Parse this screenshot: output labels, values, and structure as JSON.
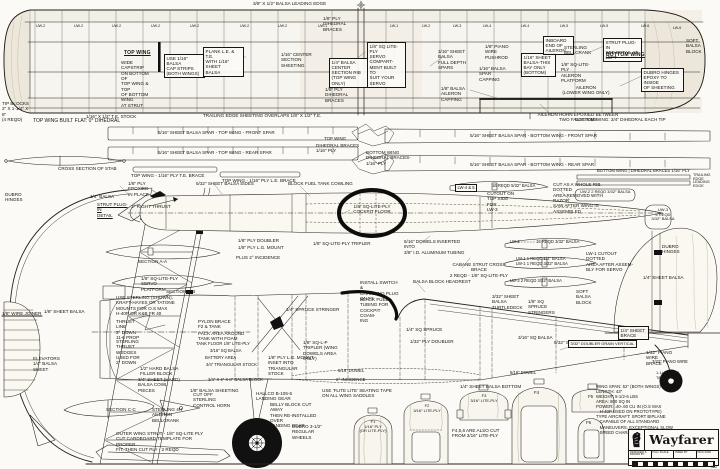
{
  "sheet": {
    "width": 720,
    "height": 469
  },
  "colors": {
    "paper": "#fbfaf6",
    "ink": "#18160f"
  },
  "title_block": {
    "title": "Wayfarer",
    "logo": "lion-crest-logo",
    "cells": [
      "DESIGNED &\nDRAWN BY",
      "FULL SCALE",
      "INKED BY",
      "DICK KIDD"
    ],
    "plan_number": "462"
  },
  "specs": {
    "lines": [
      "WING SPAN: 52″ (BOTH WINGS)",
      "LENGTH: 43″",
      "WEIGHT: 5-1/2-6 LBS",
      "AREA: 800 SQ IN",
      "POWER: .40-.60 CU IN (O.S MAX",
      "   H-40P USED ON PROTOTYPE)",
      "TYPE AIRCRAFT: SPORT BIPLANE",
      "   CAPABLE OF ALL STANDARD",
      "   MANEUVERS, EXCEPTIONAL SLOW",
      "   SPEED CHARACTERISTICS"
    ]
  },
  "annotations": [
    {
      "x": 2,
      "y": 101,
      "t": "TIP BLOCKS\n2″ X 1-1/4″ X 8″\n(4 REQD)",
      "w": 30
    },
    {
      "x": 124,
      "y": 51,
      "t": "TOP WING",
      "u": 1,
      "f": 1,
      "s": 5
    },
    {
      "x": 121,
      "y": 60,
      "t": "WIDE CAPSTRIP\nON BOTTOM OF\nTOP WING & TOP\nOF BOTTOM WING\nAT STRUT",
      "w": 34
    },
    {
      "x": 164,
      "y": 54,
      "t": "USE 1/16″ BALSA\nCAP STRIPS\n(BOTH WINGS)",
      "w": 36,
      "b": 1
    },
    {
      "x": 203,
      "y": 47,
      "t": "PLANK L.E. & T.E.\nWITH 1/16″ SHEET\nBALSA",
      "w": 36,
      "b": 1
    },
    {
      "x": 86,
      "y": 114,
      "t": "1/16″ X 1/2″ T.E. STOCK"
    },
    {
      "x": 253,
      "y": 1,
      "t": "3/8″ X 1/2″ BALSA LEADING EDGE"
    },
    {
      "x": 323,
      "y": 16,
      "t": "1/8″ PLY DIHEDRAL\nBRACES",
      "w": 38
    },
    {
      "x": 281,
      "y": 52,
      "t": "1/16″ CENTER\nSECTION SHEETING",
      "w": 36
    },
    {
      "x": 329,
      "y": 58,
      "t": "1/4″ BALSA CENTER\nSECTION RIB\n(TOP WING ONLY)",
      "w": 38,
      "b": 1
    },
    {
      "x": 367,
      "y": 42,
      "t": "1/8″ SQ LITE-PLY\nSERVO COMPART-\nMENT BUILT TO\nSUIT YOUR SERVO",
      "w": 34,
      "b": 1
    },
    {
      "x": 438,
      "y": 49,
      "t": "3/16″ SHEET BALSA\nFULL DEPTH\nSPARS",
      "w": 38
    },
    {
      "x": 325,
      "y": 87,
      "t": "1/8″ PLY DIHEDRAL\nBRACES",
      "w": 38
    },
    {
      "x": 441,
      "y": 86,
      "t": "1/8″ BALSA AILERON\nCAPPING",
      "w": 40
    },
    {
      "x": 203,
      "y": 113,
      "t": "TRAILING EDGE SHEETING OVERLAPS 1/8″ X 1/2″ T.E."
    },
    {
      "x": 485,
      "y": 44,
      "t": "1/8″ PIANO WIRE\nPUSHROD",
      "w": 32
    },
    {
      "x": 479,
      "y": 66,
      "t": "1/16″ BALSA SPAR\nCAPPING",
      "w": 32
    },
    {
      "x": 521,
      "y": 53,
      "t": "1/16″ SHEET\nBALSA-THIS\nBAY ONLY\n(BOTTOM)",
      "w": 30,
      "b": 1
    },
    {
      "x": 543,
      "y": 36,
      "t": "INBOARD\nEND OF\nAILERON",
      "w": 26,
      "b": 1
    },
    {
      "x": 564,
      "y": 45,
      "t": "STERLING\nBELLCRANK",
      "w": 28
    },
    {
      "x": 561,
      "y": 62,
      "t": "1/8″ SQ-LITE-PLY\nAILERON\nPLATFORM",
      "w": 36
    },
    {
      "x": 603,
      "y": 38,
      "t": "STRUT PLUG-IN\nSEE DETAIL AT\nLEFT",
      "w": 34,
      "b": 1
    },
    {
      "x": 606,
      "y": 53,
      "t": "BOTTOM WING",
      "u": 1,
      "f": 1,
      "s": 5
    },
    {
      "x": 686,
      "y": 38,
      "t": "SOFT\nBALSA\nBLOCK",
      "w": 24
    },
    {
      "x": 641,
      "y": 68,
      "t": "DUBRO HINGES\nEPOXY TO INSIDE\nOF SHEETING",
      "w": 38,
      "b": 1
    },
    {
      "x": 556,
      "y": 85,
      "t": "AILERON\n(LOWER WING ONLY)",
      "w": 60,
      "c": 1
    },
    {
      "x": 535,
      "y": 112,
      "t": "AILERON HORN EPOXIED BETWEEN\nTWO FALSE RIBS",
      "w": 86,
      "c": 1
    },
    {
      "x": 36,
      "y": 24,
      "t": "UW-2",
      "s": 3.6
    },
    {
      "x": 74,
      "y": 24,
      "t": "UW-2",
      "s": 3.6
    },
    {
      "x": 112,
      "y": 24,
      "t": "UW-2",
      "s": 3.6
    },
    {
      "x": 151,
      "y": 24,
      "t": "UW-2",
      "s": 3.6
    },
    {
      "x": 190,
      "y": 24,
      "t": "UW-2",
      "s": 3.6
    },
    {
      "x": 240,
      "y": 24,
      "t": "UW-2",
      "s": 3.6
    },
    {
      "x": 278,
      "y": 24,
      "t": "UW-2",
      "s": 3.6
    },
    {
      "x": 318,
      "y": 24,
      "t": "UW-1",
      "s": 3.6
    },
    {
      "x": 390,
      "y": 24,
      "t": "LW-1",
      "s": 3.6
    },
    {
      "x": 422,
      "y": 24,
      "t": "LW-2",
      "s": 3.6
    },
    {
      "x": 453,
      "y": 24,
      "t": "LW-3",
      "s": 3.6
    },
    {
      "x": 483,
      "y": 24,
      "t": "LW-4",
      "s": 3.6
    },
    {
      "x": 521,
      "y": 24,
      "t": "LW-4",
      "s": 3.6
    },
    {
      "x": 560,
      "y": 24,
      "t": "LW-5",
      "s": 3.6
    },
    {
      "x": 600,
      "y": 24,
      "t": "LW-5",
      "s": 3.6
    },
    {
      "x": 641,
      "y": 24,
      "t": "LW-6",
      "s": 3.6
    },
    {
      "x": 673,
      "y": 26,
      "t": "LW-6",
      "s": 3.6
    },
    {
      "x": 33,
      "y": 119,
      "t": "TOP WING BUILT FLAT: 0° DIHEDRAL",
      "s": 5
    },
    {
      "x": 158,
      "y": 130,
      "t": "5/16″ SHEET BALSA SPAR - TOP WING - FRONT SPAR"
    },
    {
      "x": 158,
      "y": 150,
      "t": "5/16″ SHEET BALSA SPAR - TOP WING - REAR SPAR"
    },
    {
      "x": 324,
      "y": 136,
      "t": "TOP WING",
      "s": 4.4
    },
    {
      "x": 316,
      "y": 143,
      "t": "DIHEDRAL BRACES\n1/16″ PLY",
      "w": 44
    },
    {
      "x": 58,
      "y": 166,
      "t": "CROSS SECTION OF STAB"
    },
    {
      "x": 131,
      "y": 173,
      "t": "TOP WING - 1/16″ PLY T.E. BRACE"
    },
    {
      "x": 222,
      "y": 178,
      "t": "TOP WING - 1/16″ PLY L.E. BRACE"
    },
    {
      "x": 575,
      "y": 117,
      "t": "BOTTOM WING: 3/4″ DIHEDRAL EACH TIP",
      "s": 4.6
    },
    {
      "x": 470,
      "y": 133,
      "t": "5/16″ SHEET BALSA SPAR - BOTTOM WING - FRONT SPAR"
    },
    {
      "x": 470,
      "y": 162,
      "t": "5/16″ SHEET BALSA SPAR - BOTTOM WING - REAR SPAR"
    },
    {
      "x": 366,
      "y": 150,
      "t": "BOTTOM WING DIHEDRAL BRACES-\n1/16″ PLY",
      "w": 52
    },
    {
      "x": 597,
      "y": 169,
      "t": "BOTTOM WING | DIHEDRAL BRACES 1/16″ PLY",
      "s": 4.2
    },
    {
      "x": 693,
      "y": 173,
      "t": "TRAILING EDGE",
      "s": 3.8
    },
    {
      "x": 693,
      "y": 180,
      "t": "LEADING EDGE",
      "s": 3.8
    },
    {
      "x": 455,
      "y": 184,
      "t": "LW-4 & 5",
      "b": 1,
      "s": 4.2
    },
    {
      "x": 492,
      "y": 184,
      "t": "16 REQD 5/32″ BALSA",
      "s": 4.2
    },
    {
      "x": 553,
      "y": 182,
      "t": "CUT AS A WHOLE RIB. DOTTED\nAREA REMOVED WITH RAZOR\nSAW AFTER WING IS ASSEMBLED",
      "w": 66
    },
    {
      "x": 487,
      "y": 191,
      "t": "CUTOUT ON\nTOP SIDE FOR\nLW-3",
      "w": 28
    },
    {
      "x": 5,
      "y": 192,
      "t": "DUBRO\nHINGES",
      "w": 22
    },
    {
      "x": 90,
      "y": 194,
      "t": "1/4″ BALSA"
    },
    {
      "x": 97,
      "y": 202,
      "t": "STRUT PLUG-IN\nDETAIL",
      "w": 34,
      "u": 1
    },
    {
      "x": 128,
      "y": 181,
      "t": "1/8″ PLY EPOXIED\nIN PLACE",
      "w": 36
    },
    {
      "x": 131,
      "y": 204,
      "t": "3° RIGHT THRUST"
    },
    {
      "x": 196,
      "y": 181,
      "t": "5/32″ SHEET BALSA SIDES"
    },
    {
      "x": 288,
      "y": 181,
      "t": "BLOCK FUEL TANK COWLING"
    },
    {
      "x": 352,
      "y": 204,
      "t": "1/8″ SQ-LITE-PLY\nCOCKPIT FLOOR",
      "w": 40,
      "c": 1
    },
    {
      "x": 313,
      "y": 241,
      "t": "1/8″ SQ-LITE-PLY TRIPLER"
    },
    {
      "x": 404,
      "y": 239,
      "t": "5/16″ DOWELS INSERTED INTO\n3/8″ I.D. ALUMINUM TUBING",
      "w": 64
    },
    {
      "x": 238,
      "y": 238,
      "t": "1/8″ PLY DOUBLER"
    },
    {
      "x": 238,
      "y": 245,
      "t": "1/8″ PLY L.G. MOUNT"
    },
    {
      "x": 236,
      "y": 255,
      "t": "PLUS 2° INCIDENCE"
    },
    {
      "x": 446,
      "y": 262,
      "t": "CABANE STRUT CROSS BRACE\n2 REQD - 1/8″ SQ-LITE-PLY",
      "w": 66,
      "c": 1
    },
    {
      "x": 360,
      "y": 280,
      "t": "INSTALL SWITCH &\nCHARGING PLUG\nON F3",
      "w": 40
    },
    {
      "x": 413,
      "y": 279,
      "t": "BALSA BLOCK HEADREST"
    },
    {
      "x": 360,
      "y": 297,
      "t": "BLACK FUEL\nTUBING FOR\nCOCKPIT COAM-\nING",
      "w": 30
    },
    {
      "x": 510,
      "y": 240,
      "t": "LW-2",
      "s": 4.2
    },
    {
      "x": 536,
      "y": 240,
      "t": "16 REQD 3/32″ BALSA",
      "s": 4.2
    },
    {
      "x": 516,
      "y": 257,
      "t": "LW-1   1 REQD 1/4″ BALSA\nLW-1   1 REQD 3/32″ BALSA",
      "s": 4.2
    },
    {
      "x": 586,
      "y": 251,
      "t": "LW-1 CUTOUT DOTTED\nAREA AFTER ASSEM-\nBLY FOR SERVO",
      "w": 50
    },
    {
      "x": 510,
      "y": 279,
      "t": "LW-3   2 REQD 3/32″ BALSA",
      "s": 4.2
    },
    {
      "x": 580,
      "y": 190,
      "t": "UW-2   2 REQD 3/32″ BALSA",
      "s": 4
    },
    {
      "x": 650,
      "y": 208,
      "t": "UW-3\n4 REQD\n3/32″ BALSA",
      "w": 26,
      "c": 1,
      "s": 4
    },
    {
      "x": 643,
      "y": 275,
      "t": "1/4″ SHEET BALSA"
    },
    {
      "x": 662,
      "y": 244,
      "t": "DUBRO\nHINGES",
      "w": 22
    },
    {
      "x": 166,
      "y": 289,
      "t": "SECTION B-B"
    },
    {
      "x": 116,
      "y": 295,
      "t": "USE STERLING (SHOWN),\nKRAFT-HAYES OR TATONE\nMOUNTS FOR O.S MAX\nH-40P OR K&B FR 40",
      "w": 60
    },
    {
      "x": 2,
      "y": 311,
      "t": "1/8″ WIRE JOINER"
    },
    {
      "x": 44,
      "y": 309,
      "t": "1/8″ SHEET BALSA"
    },
    {
      "x": 33,
      "y": 356,
      "t": "ELEVATORS\n1/4″ BALSA\nSHEET",
      "w": 28
    },
    {
      "x": 116,
      "y": 319,
      "t": "THRUST LINE\n2° DOWN\n11-6 PROP",
      "w": 30
    },
    {
      "x": 116,
      "y": 339,
      "t": "STERLING\nTHRUST\nWEDGES\nUSED FOR\n2° DOWN",
      "w": 26
    },
    {
      "x": 198,
      "y": 319,
      "t": "PYLON BRACE\nF2 & TANK",
      "w": 34
    },
    {
      "x": 198,
      "y": 331,
      "t": "PACK AREA AROUND\nTANK WITH FOAM",
      "w": 48
    },
    {
      "x": 196,
      "y": 342,
      "t": "TANK FLOOR 1/8″ LITE-PLY",
      "s": 4.2
    },
    {
      "x": 210,
      "y": 349,
      "t": "3/16″ SQ BALSA",
      "s": 4.2
    },
    {
      "x": 205,
      "y": 356,
      "t": "BATTERY AREA",
      "s": 4.2
    },
    {
      "x": 206,
      "y": 363,
      "t": "3/4″ TRIANGULAR STOCK",
      "s": 4.2
    },
    {
      "x": 140,
      "y": 366,
      "t": "1/2″ HARD BALSA\nFILLER BLOCK",
      "w": 40
    },
    {
      "x": 138,
      "y": 377,
      "t": "3/4″ SHEET (HARD)\nBALSA COWL PIECES",
      "w": 46
    },
    {
      "x": 208,
      "y": 378,
      "t": "3/4″ X 4″ X 8″ BALSA BLOCK",
      "s": 4.2
    },
    {
      "x": 190,
      "y": 388,
      "t": "1/8″ BALSA SHEETING"
    },
    {
      "x": 286,
      "y": 307,
      "t": "1/4″ SPRUCE STRINGER"
    },
    {
      "x": 303,
      "y": 340,
      "t": "1/8″ SQ-L-P\nTRIPLER (WING\nDOWELS AREA ONLY)",
      "w": 40
    },
    {
      "x": 406,
      "y": 327,
      "t": "1/4″ SQ SPRUCE"
    },
    {
      "x": 410,
      "y": 339,
      "t": "1/32″ PLY DOUBLER"
    },
    {
      "x": 554,
      "y": 340,
      "t": "5/32″ SHEET BALSA SIDES"
    },
    {
      "x": 268,
      "y": 355,
      "t": "1/8″ PLY L.G. MOUNT\nINSET INTO TRIANGULAR\nSTOCK",
      "w": 50
    },
    {
      "x": 338,
      "y": 369,
      "t": "5/16″ DOWEL",
      "s": 4.2
    },
    {
      "x": 510,
      "y": 371,
      "t": "5/16″ DOWEL",
      "s": 4.2
    },
    {
      "x": 336,
      "y": 377,
      "t": "2° INCIDENCE",
      "s": 4.4
    },
    {
      "x": 322,
      "y": 388,
      "t": "USE 'FLITE LITE' SEATING TAPE\nON ALL WING SADDLES",
      "w": 72
    },
    {
      "x": 256,
      "y": 391,
      "t": "HALLCO B-105-5\nLANDING GEAR",
      "w": 36
    },
    {
      "x": 270,
      "y": 402,
      "t": "BELLY BLOCK CUT AWAY\nTHEN RE-INSTALLED OVER\nLANDING GEAR",
      "w": 52
    },
    {
      "x": 292,
      "y": 424,
      "t": "DUBRO 3-1/2″\nREGULAR WHEELS",
      "w": 36
    },
    {
      "x": 193,
      "y": 392,
      "t": "CUT OFF STERLING\nCONTROL HORN",
      "w": 40
    },
    {
      "x": 106,
      "y": 407,
      "t": "SECTION C-C"
    },
    {
      "x": 152,
      "y": 407,
      "t": "STERLING 4H\nAILERON BELLCRANK",
      "w": 44
    },
    {
      "x": 116,
      "y": 431,
      "t": "OUTER WING STRUT - 1/8″ SQ-LITE PLY\nCUT CARDBOARD TEMPLATE FOR PROPER\nFIT, THEN CUT PLY - 2 REQD",
      "w": 92
    },
    {
      "x": 492,
      "y": 294,
      "t": "3/32″ SHEET BALSA\nTURTLEDECK",
      "w": 42
    },
    {
      "x": 528,
      "y": 299,
      "t": "1/8″ SQ SPRUCE\nSTRINGERS",
      "w": 36
    },
    {
      "x": 576,
      "y": 289,
      "t": "SOFT BALSA\nBLOCK",
      "w": 28
    },
    {
      "x": 518,
      "y": 335,
      "t": "3/16″ SQ BALSA"
    },
    {
      "x": 618,
      "y": 326,
      "t": "1/4″ SHEET\nBRACE",
      "w": 26,
      "b": 1
    },
    {
      "x": 568,
      "y": 340,
      "t": "3/32″ DOUBLER GRAIN VERTICAL",
      "s": 4,
      "b": 1
    },
    {
      "x": 646,
      "y": 350,
      "t": "1/32″ PIANO WIRE\nBRACE",
      "w": 34
    },
    {
      "x": 652,
      "y": 360,
      "t": "3/32″ PIANO WIRE",
      "s": 4.2
    },
    {
      "x": 656,
      "y": 371,
      "t": "1-1/4″ REQD\nTAIL WHEEL",
      "w": 28,
      "s": 4
    },
    {
      "x": 460,
      "y": 384,
      "t": "1/4″ SHEET BALSA BOTTOM"
    },
    {
      "x": 138,
      "y": 259,
      "t": "SECTION A-A"
    },
    {
      "x": 141,
      "y": 276,
      "t": "1/8″ SQ-LITE-PLY\nSERVO PLATFORM",
      "w": 40
    },
    {
      "x": 356,
      "y": 420,
      "t": "F1\n1/16″ PLY\n(OR LITE-PLY)",
      "w": 34,
      "c": 1,
      "s": 4
    },
    {
      "x": 408,
      "y": 404,
      "t": "F2\n3/16″ LITE-PLY",
      "w": 38,
      "c": 1,
      "s": 4
    },
    {
      "x": 464,
      "y": 394,
      "t": "F3\n3/16″ LITE-PLY",
      "w": 40,
      "c": 1,
      "s": 4
    },
    {
      "x": 452,
      "y": 428,
      "t": "F4,5,6 ARE ALSO CUT\nFROM 3/16″ LITE-PLY",
      "w": 48
    },
    {
      "x": 534,
      "y": 390,
      "t": "F4",
      "s": 4.4
    },
    {
      "x": 588,
      "y": 394,
      "t": "F5",
      "s": 4.4
    },
    {
      "x": 586,
      "y": 420,
      "t": "F6",
      "s": 4.4
    }
  ]
}
